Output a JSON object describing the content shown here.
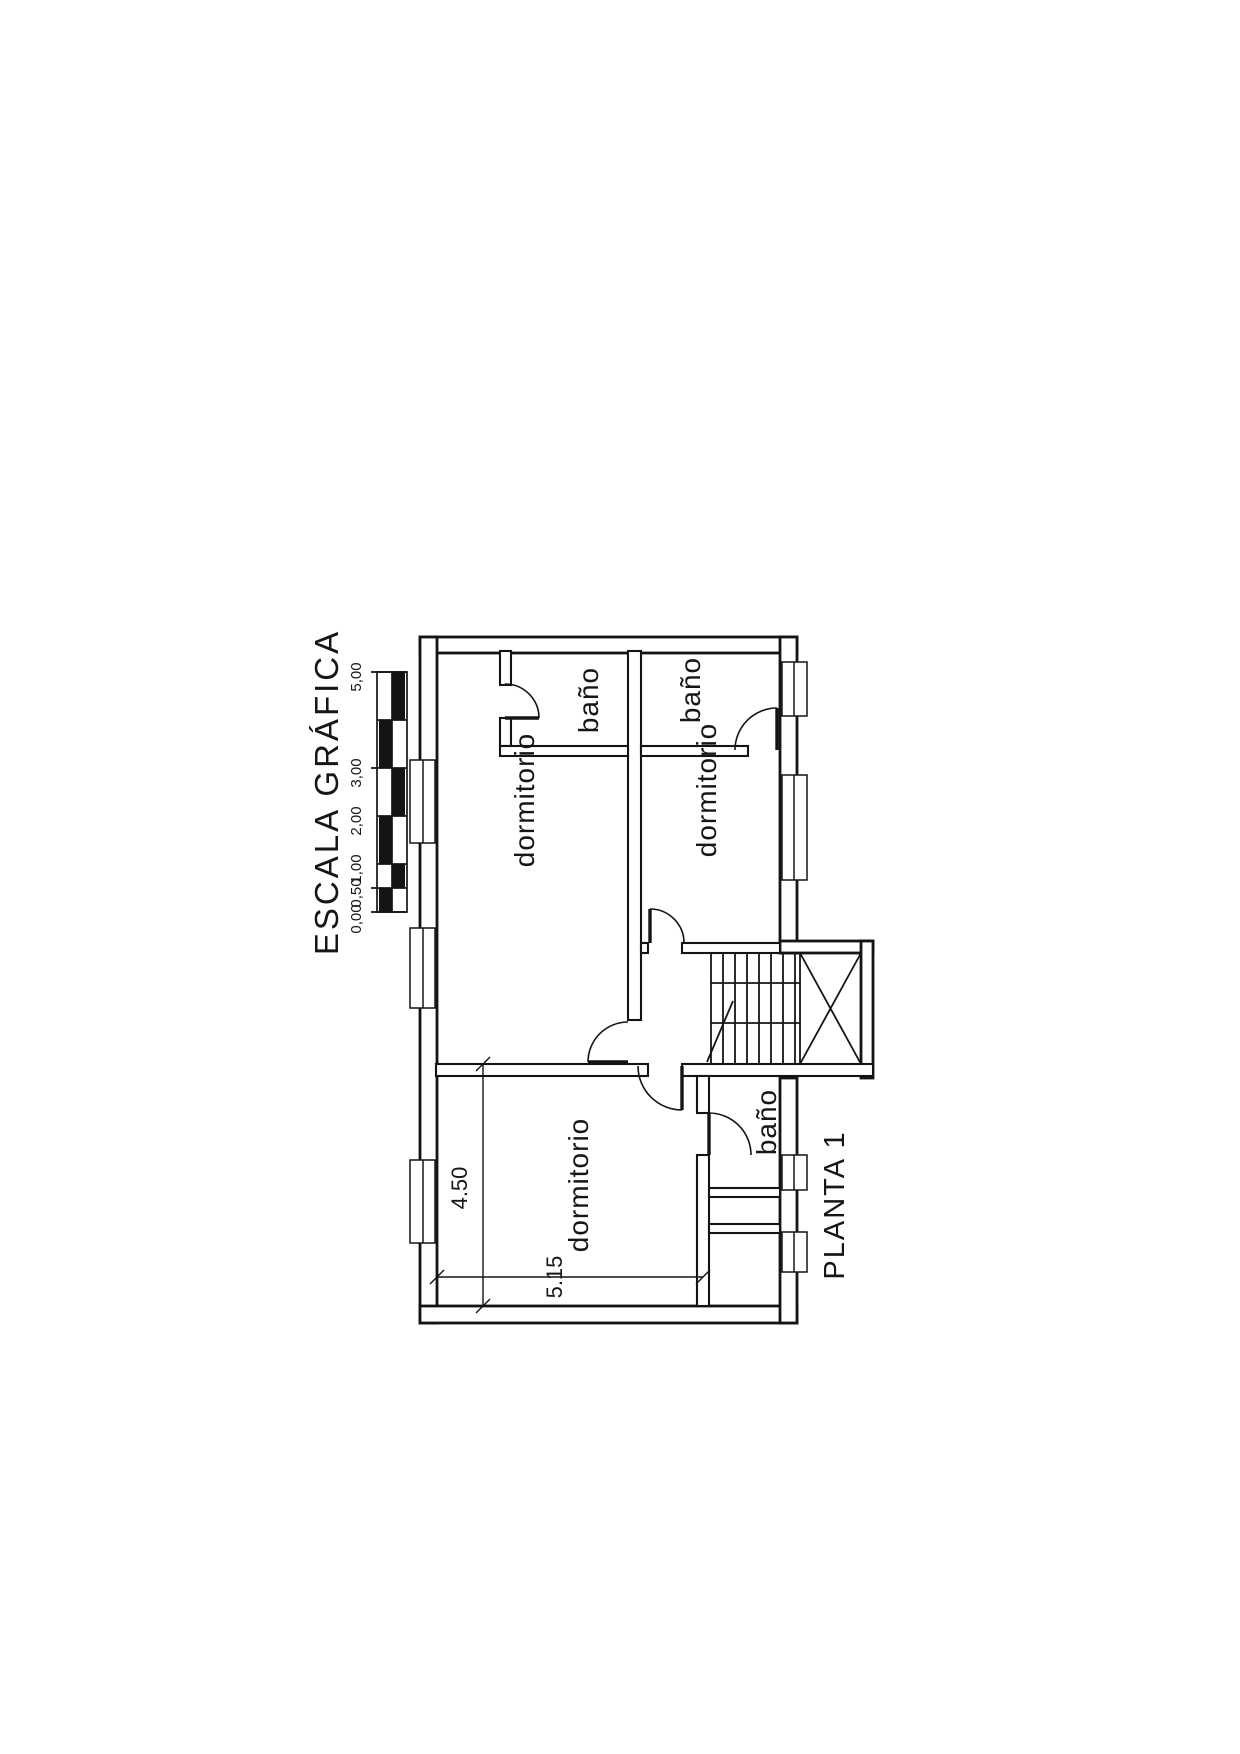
{
  "drawing": {
    "scale_bar": {
      "title": "ESCALA GRÁFICA",
      "tick_labels": [
        "0,00",
        "0,50",
        "1,00",
        "2,00",
        "3,00",
        "5,00"
      ]
    },
    "plan": {
      "title": "PLANTA 1",
      "rooms": [
        {
          "name": "dormitorio-top-left",
          "label": "dormitorio"
        },
        {
          "name": "bano-top-left",
          "label": "baño"
        },
        {
          "name": "bano-top-right",
          "label": "baño"
        },
        {
          "name": "dormitorio-right",
          "label": "dormitorio"
        },
        {
          "name": "dormitorio-bottom",
          "label": "dormitorio"
        },
        {
          "name": "bano-bottom",
          "label": "baño"
        }
      ],
      "dimensions": [
        {
          "name": "room-height",
          "value": "4.50"
        },
        {
          "name": "room-width",
          "value": "5.15"
        }
      ]
    }
  }
}
